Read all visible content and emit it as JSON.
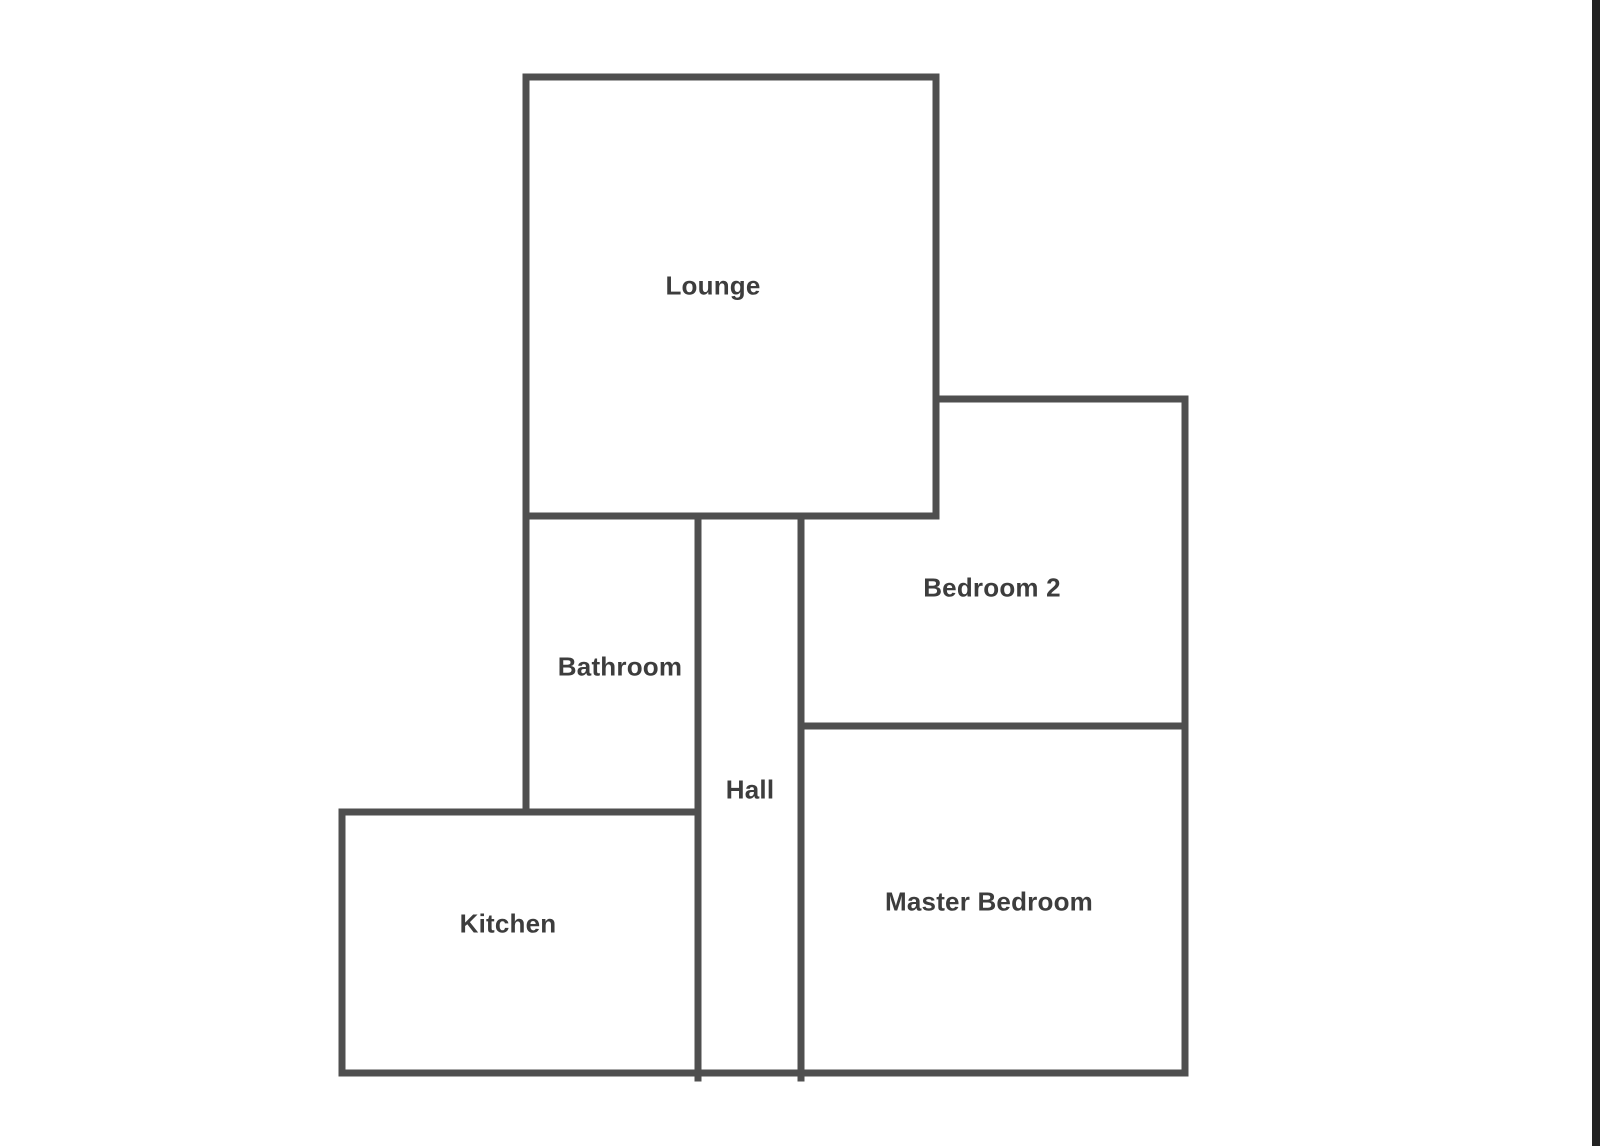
{
  "floorplan": {
    "title": "Apartment floor plan",
    "wall_color": "#4f4f4f",
    "label_color": "#3d3d3d",
    "rooms": [
      {
        "id": "lounge",
        "label": "Lounge"
      },
      {
        "id": "bathroom",
        "label": "Bathroom"
      },
      {
        "id": "hall",
        "label": "Hall"
      },
      {
        "id": "kitchen",
        "label": "Kitchen"
      },
      {
        "id": "bedroom2",
        "label": "Bedroom 2"
      },
      {
        "id": "master-bedroom",
        "label": "Master Bedroom"
      }
    ]
  },
  "screen": {
    "background_color": "#ffffff",
    "right_edge_bar_color": "#232323"
  }
}
